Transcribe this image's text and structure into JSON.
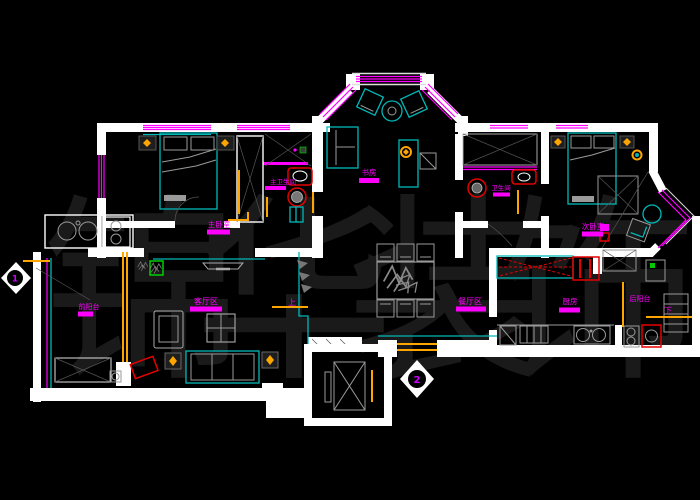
{
  "drawing": {
    "type": "apartment floor plan (CAD)",
    "watermark": "锦华装饰",
    "rooms": {
      "master_bedroom": "主卧室",
      "master_bathroom": "主卫生间",
      "study": "书房",
      "bathroom": "卫生间",
      "second_bedroom": "次卧室",
      "front_balcony": "前阳台",
      "living_area": "客厅区",
      "dining_area": "餐厅区",
      "kitchen": "厨房",
      "back_balcony": "后阳台"
    },
    "markers": {
      "up": "上",
      "down": "下",
      "level_1": "1",
      "level_2": "2"
    },
    "colors": {
      "background": "#000000",
      "wall": "#ffffff",
      "window": "#ff00ff",
      "furniture": "#00b8b8",
      "detail": "#9a9a9a",
      "accent": "#ffa500",
      "fixture": "#e60000",
      "label": "#ff00ff",
      "watermark": "#1a1a1a"
    }
  }
}
